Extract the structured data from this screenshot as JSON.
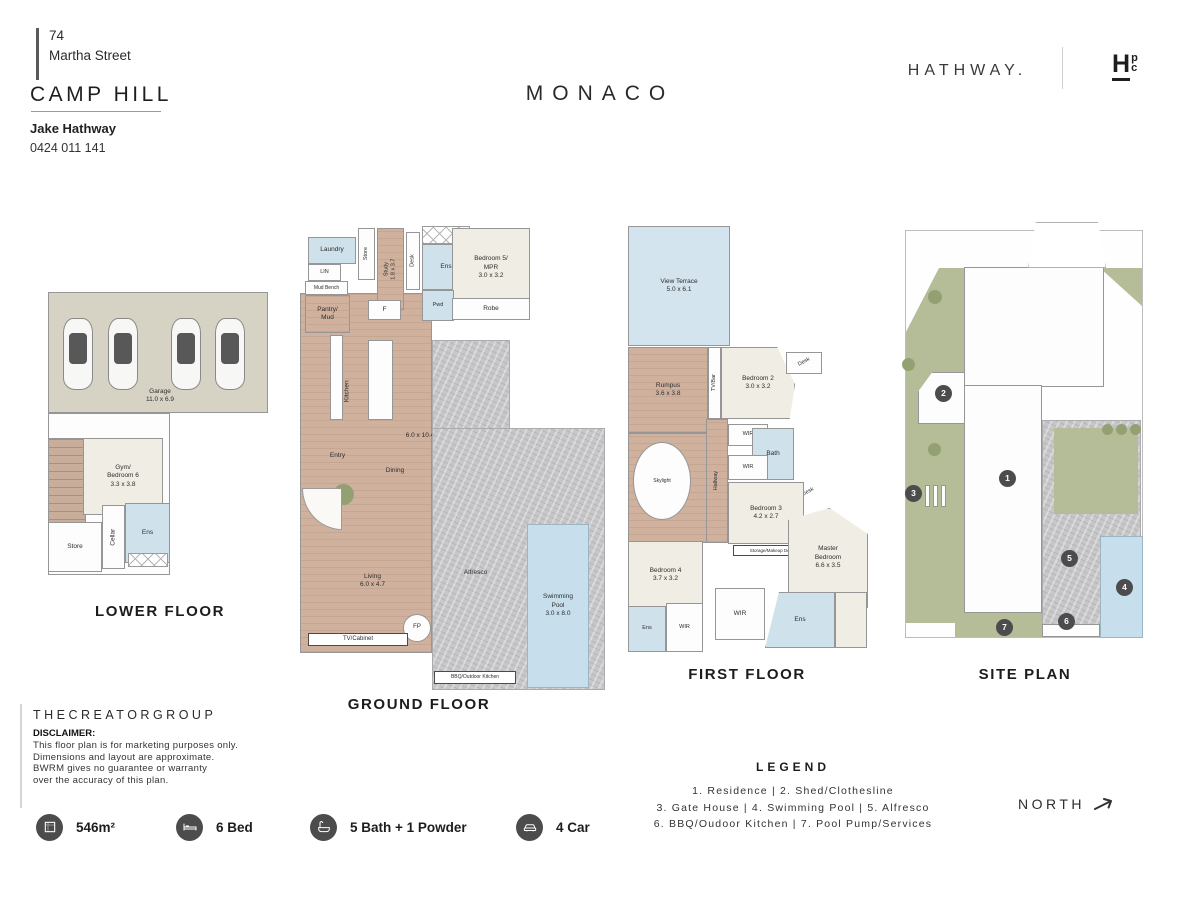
{
  "header": {
    "street_number": "74",
    "street_name": "Martha Street",
    "suburb": "CAMP HILL",
    "agent_name": "Jake Hathway",
    "agent_phone": "0424 011 141",
    "plan_title": "MONACO",
    "brand": "HATHWAY.",
    "logo_main": "H",
    "logo_top": "p",
    "logo_bottom": "c"
  },
  "floors": [
    {
      "id": "lower",
      "title": "LOWER FLOOR",
      "title_x": 160,
      "title_y": 603,
      "rooms": [
        {
          "label": "",
          "fill": "garage",
          "x": 48,
          "y": 292,
          "w": 220,
          "h": 121
        },
        {
          "label": "",
          "fill": "white",
          "x": 48,
          "y": 413,
          "w": 122,
          "h": 162
        },
        {
          "label": "",
          "fill": "stairs",
          "x": 48,
          "y": 438,
          "w": 38,
          "h": 130
        },
        {
          "label": "Gym/\nBedroom 6\n3.3 x 3.8",
          "fill": "carpet",
          "x": 83,
          "y": 438,
          "w": 80,
          "h": 77
        },
        {
          "label": "Store",
          "fill": "white",
          "x": 48,
          "y": 522,
          "w": 54,
          "h": 50
        },
        {
          "label": "Cellar",
          "fill": "white",
          "rot": -90,
          "x": 102,
          "y": 505,
          "w": 23,
          "h": 64
        },
        {
          "label": "Ens",
          "fill": "wet",
          "x": 125,
          "y": 503,
          "w": 45,
          "h": 60
        },
        {
          "label": "",
          "fill": "hatch",
          "x": 128,
          "y": 553,
          "w": 40,
          "h": 14
        },
        {
          "label": "",
          "fill": "car",
          "x": 63,
          "y": 318,
          "w": 30,
          "h": 72
        },
        {
          "label": "",
          "fill": "car",
          "x": 108,
          "y": 318,
          "w": 30,
          "h": 72
        },
        {
          "label": "",
          "fill": "car",
          "x": 171,
          "y": 318,
          "w": 30,
          "h": 72
        },
        {
          "label": "",
          "fill": "car",
          "x": 215,
          "y": 318,
          "w": 30,
          "h": 72
        },
        {
          "label": "Garage\n11.0 x 6.9",
          "fill": "label",
          "x": 110,
          "y": 384,
          "w": 100,
          "h": 24
        }
      ]
    },
    {
      "id": "ground",
      "title": "GROUND FLOOR",
      "title_x": 419,
      "title_y": 696,
      "rooms": [
        {
          "label": "",
          "fill": "wood",
          "x": 300,
          "y": 293,
          "w": 132,
          "h": 360
        },
        {
          "label": "Laundry",
          "fill": "wet",
          "x": 308,
          "y": 237,
          "w": 48,
          "h": 27
        },
        {
          "label": "Store",
          "fill": "white",
          "rot": -90,
          "x": 358,
          "y": 228,
          "w": 17,
          "h": 52,
          "fs": 5.5
        },
        {
          "label": "Study\n1.8 x 3.7",
          "fill": "wood",
          "rot": -90,
          "x": 377,
          "y": 228,
          "w": 27,
          "h": 82,
          "fs": 5.5
        },
        {
          "label": "Desk",
          "fill": "white",
          "rot": -90,
          "x": 406,
          "y": 232,
          "w": 14,
          "h": 58,
          "fs": 5.5
        },
        {
          "label": "",
          "fill": "hatch",
          "x": 422,
          "y": 226,
          "w": 48,
          "h": 18
        },
        {
          "label": "Ens",
          "fill": "wet",
          "x": 422,
          "y": 244,
          "w": 48,
          "h": 46
        },
        {
          "label": "Bedroom 5/\nMPR\n3.0 x 3.2",
          "fill": "carpet",
          "x": 452,
          "y": 228,
          "w": 78,
          "h": 80
        },
        {
          "label": "LIN",
          "fill": "white",
          "x": 308,
          "y": 264,
          "w": 33,
          "h": 17,
          "fs": 5.5
        },
        {
          "label": "Mud Bench",
          "fill": "white",
          "x": 305,
          "y": 281,
          "w": 43,
          "h": 14,
          "fs": 5
        },
        {
          "label": "Pantry/\nMud",
          "fill": "wood",
          "x": 305,
          "y": 295,
          "w": 45,
          "h": 38
        },
        {
          "label": "F",
          "fill": "white",
          "x": 368,
          "y": 300,
          "w": 33,
          "h": 20
        },
        {
          "label": "Pwd",
          "fill": "wet",
          "x": 422,
          "y": 290,
          "w": 32,
          "h": 31,
          "fs": 5.5
        },
        {
          "label": "Robe",
          "fill": "white",
          "x": 452,
          "y": 298,
          "w": 78,
          "h": 22
        },
        {
          "label": "",
          "fill": "white",
          "x": 330,
          "y": 335,
          "w": 13,
          "h": 85
        },
        {
          "label": "",
          "fill": "white",
          "x": 368,
          "y": 340,
          "w": 25,
          "h": 80
        },
        {
          "label": "Kitchen",
          "fill": "label",
          "rot": -90,
          "x": 328,
          "y": 385,
          "w": 40,
          "h": 12
        },
        {
          "label": "6.0 x 10.4",
          "fill": "label",
          "x": 390,
          "y": 430,
          "w": 60,
          "h": 12
        },
        {
          "label": "Entry",
          "fill": "label",
          "x": 315,
          "y": 450,
          "w": 45,
          "h": 12
        },
        {
          "label": "Dining",
          "fill": "label",
          "x": 370,
          "y": 465,
          "w": 50,
          "h": 12
        },
        {
          "label": "",
          "fill": "greendark",
          "circle": true,
          "x": 333,
          "y": 484,
          "w": 21,
          "h": 21
        },
        {
          "label": "",
          "fill": "fan",
          "x": 302,
          "y": 488,
          "w": 40,
          "h": 42
        },
        {
          "label": "Living\n6.0 x 4.7",
          "fill": "label",
          "x": 345,
          "y": 570,
          "w": 55,
          "h": 22
        },
        {
          "label": "FP",
          "fill": "white",
          "circle": true,
          "x": 403,
          "y": 614,
          "w": 28,
          "h": 28,
          "fs": 6
        },
        {
          "label": "TV/Cabinet",
          "fill": "labelbox",
          "x": 308,
          "y": 633,
          "w": 100,
          "h": 13,
          "fs": 6
        },
        {
          "label": "",
          "fill": "stone",
          "x": 432,
          "y": 340,
          "w": 78,
          "h": 90
        },
        {
          "label": "",
          "fill": "stone",
          "x": 432,
          "y": 428,
          "w": 173,
          "h": 262
        },
        {
          "label": "Alfresco",
          "fill": "label",
          "x": 448,
          "y": 567,
          "w": 55,
          "h": 12
        },
        {
          "label": "Swimming\nPool\n3.0 x 8.0",
          "fill": "pool",
          "x": 527,
          "y": 524,
          "w": 62,
          "h": 164
        },
        {
          "label": "BBQ/Outdoor Kitchen",
          "fill": "labelbox",
          "x": 434,
          "y": 671,
          "w": 82,
          "h": 13,
          "fs": 5
        }
      ]
    },
    {
      "id": "first",
      "title": "FIRST FLOOR",
      "title_x": 747,
      "title_y": 666,
      "rooms": [
        {
          "label": "View Terrace\n5.0 x 6.1",
          "fill": "terrace",
          "x": 628,
          "y": 226,
          "w": 102,
          "h": 120
        },
        {
          "label": "Rumpus\n3.6 x 3.8",
          "fill": "wood",
          "x": 628,
          "y": 347,
          "w": 80,
          "h": 86
        },
        {
          "label": "TV/Bar",
          "fill": "white",
          "rot": -90,
          "x": 708,
          "y": 347,
          "w": 13,
          "h": 72,
          "fs": 5.5
        },
        {
          "label": "Bedroom 2\n3.0 x 3.2",
          "fill": "carpet",
          "x": 721,
          "y": 347,
          "w": 74,
          "h": 72,
          "clip": "polygon(0 0, 76% 0, 100% 52%, 93% 100%, 0 100%)"
        },
        {
          "label": "Desk",
          "fill": "white",
          "rot": -28,
          "x": 786,
          "y": 352,
          "w": 36,
          "h": 22,
          "fs": 5.5
        },
        {
          "label": "",
          "fill": "wood",
          "x": 628,
          "y": 433,
          "w": 93,
          "h": 110
        },
        {
          "label": "Skylight",
          "fill": "white",
          "circle": true,
          "x": 633,
          "y": 442,
          "w": 58,
          "h": 78,
          "fs": 5
        },
        {
          "label": "Hallway",
          "fill": "wood",
          "rot": -90,
          "x": 706,
          "y": 419,
          "w": 22,
          "h": 124,
          "fs": 5.5
        },
        {
          "label": "WIR",
          "fill": "white",
          "x": 728,
          "y": 424,
          "w": 40,
          "h": 22,
          "fs": 5.5
        },
        {
          "label": "Bath",
          "fill": "wet",
          "x": 752,
          "y": 428,
          "w": 42,
          "h": 52
        },
        {
          "label": "WIR",
          "fill": "white",
          "x": 728,
          "y": 455,
          "w": 40,
          "h": 25,
          "fs": 5.5
        },
        {
          "label": "Desk",
          "fill": "label",
          "rot": -28,
          "x": 790,
          "y": 486,
          "w": 36,
          "h": 14,
          "fs": 5.5
        },
        {
          "label": "Bedroom 3\n4.2 x 2.7",
          "fill": "carpet",
          "x": 728,
          "y": 482,
          "w": 76,
          "h": 62
        },
        {
          "label": "Storage/Makeup Desk",
          "fill": "labelbox",
          "x": 733,
          "y": 545,
          "w": 78,
          "h": 11,
          "fs": 4.5
        },
        {
          "label": "Master\nBedroom\n6.6 x 3.5",
          "fill": "carpet",
          "x": 788,
          "y": 508,
          "w": 80,
          "h": 100,
          "clip": "polygon(0 12%, 52% 0, 100% 26%, 100% 100%, 0 100%)"
        },
        {
          "label": "Bedroom 4\n3.7 x 3.2",
          "fill": "carpet",
          "x": 628,
          "y": 541,
          "w": 75,
          "h": 68
        },
        {
          "label": "Ens",
          "fill": "wet",
          "x": 628,
          "y": 606,
          "w": 38,
          "h": 46,
          "fs": 5.5
        },
        {
          "label": "WIR",
          "fill": "white",
          "x": 666,
          "y": 603,
          "w": 37,
          "h": 49,
          "fs": 5.5
        },
        {
          "label": "WIR",
          "fill": "white",
          "x": 715,
          "y": 588,
          "w": 50,
          "h": 52
        },
        {
          "label": "Ens",
          "fill": "wet",
          "x": 765,
          "y": 592,
          "w": 70,
          "h": 56,
          "clip": "polygon(20% 0, 100% 0, 100% 100%, 0 100%)"
        },
        {
          "label": "",
          "fill": "carpet",
          "x": 835,
          "y": 592,
          "w": 32,
          "h": 56
        }
      ]
    },
    {
      "id": "site",
      "title": "SITE PLAN",
      "title_x": 1025,
      "title_y": 666,
      "rooms": [
        {
          "label": "",
          "fill": "siteborder",
          "x": 905,
          "y": 230,
          "w": 238,
          "h": 408
        },
        {
          "label": "",
          "fill": "green",
          "x": 906,
          "y": 268,
          "w": 60,
          "h": 355,
          "clip": "polygon(0 18%, 55% 0, 100% 0, 100% 100%, 0 100%)"
        },
        {
          "label": "",
          "fill": "green",
          "x": 955,
          "y": 598,
          "w": 90,
          "h": 39
        },
        {
          "label": "",
          "fill": "green",
          "x": 1100,
          "y": 268,
          "w": 42,
          "h": 38,
          "clip": "polygon(100% 0, 100% 100%, 0 0)"
        },
        {
          "label": "",
          "fill": "white",
          "x": 918,
          "y": 372,
          "w": 48,
          "h": 52,
          "clip": "polygon(30% 0, 100% 0, 100% 100%, 0 100%, 0 38%)"
        },
        {
          "label": "",
          "fill": "white",
          "x": 964,
          "y": 267,
          "w": 140,
          "h": 120
        },
        {
          "label": "",
          "fill": "white",
          "x": 964,
          "y": 385,
          "w": 78,
          "h": 228
        },
        {
          "label": "",
          "fill": "stone",
          "x": 1042,
          "y": 420,
          "w": 99,
          "h": 217
        },
        {
          "label": "",
          "fill": "green",
          "x": 1054,
          "y": 428,
          "w": 84,
          "h": 86
        },
        {
          "label": "",
          "fill": "pool",
          "x": 1100,
          "y": 536,
          "w": 43,
          "h": 102
        },
        {
          "label": "",
          "fill": "white",
          "x": 1042,
          "y": 624,
          "w": 58,
          "h": 13
        },
        {
          "label": "",
          "fill": "drive",
          "x": 1028,
          "y": 222,
          "w": 78,
          "h": 46,
          "clip": "polygon(10% 0, 90% 0, 100% 100%, 0 100%)"
        },
        {
          "label": "",
          "fill": "greendark",
          "circle": true,
          "x": 928,
          "y": 290,
          "w": 14,
          "h": 14
        },
        {
          "label": "",
          "fill": "greendark",
          "circle": true,
          "x": 902,
          "y": 358,
          "w": 13,
          "h": 13
        },
        {
          "label": "",
          "fill": "greendark",
          "circle": true,
          "x": 928,
          "y": 443,
          "w": 13,
          "h": 13
        },
        {
          "label": "",
          "fill": "greendark",
          "circle": true,
          "x": 1102,
          "y": 424,
          "w": 11,
          "h": 11
        },
        {
          "label": "",
          "fill": "greendark",
          "circle": true,
          "x": 1116,
          "y": 424,
          "w": 11,
          "h": 11
        },
        {
          "label": "",
          "fill": "greendark",
          "circle": true,
          "x": 1130,
          "y": 424,
          "w": 11,
          "h": 11
        },
        {
          "label": "",
          "fill": "white",
          "x": 925,
          "y": 485,
          "w": 5,
          "h": 22
        },
        {
          "label": "",
          "fill": "white",
          "x": 933,
          "y": 485,
          "w": 5,
          "h": 22
        },
        {
          "label": "",
          "fill": "white",
          "x": 941,
          "y": 485,
          "w": 5,
          "h": 22
        },
        {
          "label": "1",
          "fill": "marker",
          "circle": true,
          "x": 999,
          "y": 470,
          "w": 17,
          "h": 17
        },
        {
          "label": "2",
          "fill": "marker",
          "circle": true,
          "x": 935,
          "y": 385,
          "w": 17,
          "h": 17
        },
        {
          "label": "3",
          "fill": "marker",
          "circle": true,
          "x": 905,
          "y": 485,
          "w": 17,
          "h": 17
        },
        {
          "label": "4",
          "fill": "marker",
          "circle": true,
          "x": 1116,
          "y": 579,
          "w": 17,
          "h": 17
        },
        {
          "label": "5",
          "fill": "marker",
          "circle": true,
          "x": 1061,
          "y": 550,
          "w": 17,
          "h": 17
        },
        {
          "label": "6",
          "fill": "marker",
          "circle": true,
          "x": 1058,
          "y": 613,
          "w": 17,
          "h": 17
        },
        {
          "label": "7",
          "fill": "marker",
          "circle": true,
          "x": 996,
          "y": 619,
          "w": 17,
          "h": 17
        }
      ]
    }
  ],
  "footer": {
    "company": "THECREATORGROUP",
    "disclaimer_title": "DISCLAIMER:",
    "disclaimer_lines": [
      "This floor plan is for marketing purposes only.",
      "Dimensions and layout are approximate.",
      "BWRM gives no guarantee or warranty",
      "over the accuracy of this plan."
    ],
    "stats": [
      {
        "icon": "area-icon",
        "label": "546m²",
        "x": 36
      },
      {
        "icon": "bed-icon",
        "label": "6 Bed",
        "x": 176
      },
      {
        "icon": "bath-icon",
        "label": "5 Bath + 1 Powder",
        "x": 310
      },
      {
        "icon": "car-icon",
        "label": "4 Car",
        "x": 516
      }
    ],
    "legend": {
      "title": "LEGEND",
      "lines": [
        "1. Residence   |   2. Shed/Clothesline",
        "3. Gate House   |   4. Swimming Pool   |   5. Alfresco",
        "6. BBQ/Oudoor Kitchen   |   7. Pool Pump/Services"
      ]
    },
    "north_label": "NORTH"
  }
}
